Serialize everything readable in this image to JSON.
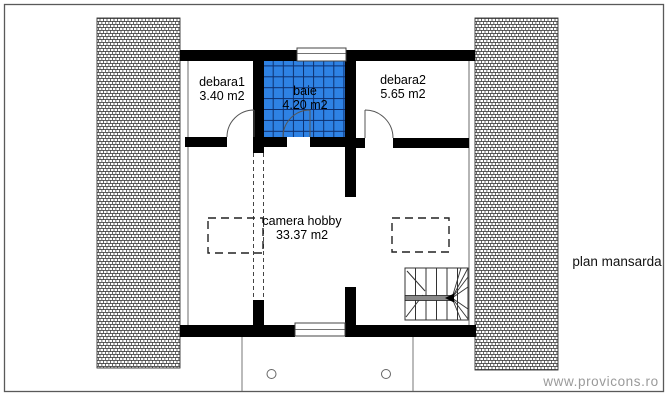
{
  "drawing_title": "plan mansarda",
  "watermark": "www.provicons.ro",
  "rooms": {
    "debara1": {
      "name": "debara1",
      "area": "3.40 m2"
    },
    "baie": {
      "name": "baie",
      "area": "4.20 m2"
    },
    "debara2": {
      "name": "debara2",
      "area": "5.65 m2"
    },
    "camera_hobby": {
      "name": "camera hobby",
      "area": "33.37 m2"
    }
  },
  "colors": {
    "tile_blue": "#2e82e4",
    "tile_grid": "#0d2f6e",
    "wall_black": "#000000",
    "watermark_gray": "#9a9a9a"
  }
}
